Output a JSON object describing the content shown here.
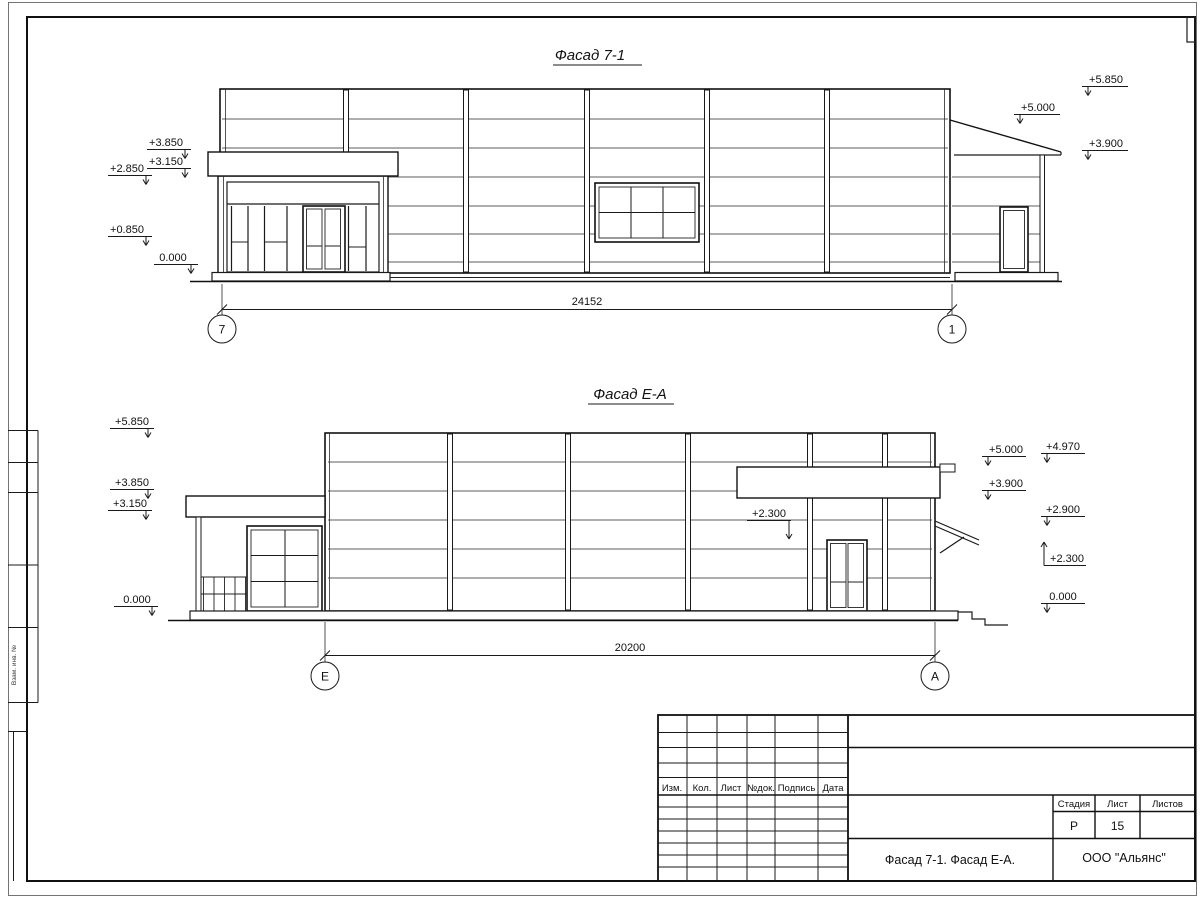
{
  "facade1": {
    "title": "Фасад 7-1",
    "marks_left": [
      "+3.850",
      "+3.150",
      "+2.850",
      "+0.850",
      "0.000"
    ],
    "marks_right": [
      "+5.850",
      "+5.000",
      "+3.900"
    ],
    "dimension": "24152",
    "axis_left": "7",
    "axis_right": "1"
  },
  "facade2": {
    "title": "Фасад Е-А",
    "marks_left": [
      "+5.850",
      "+3.850",
      "+3.150",
      "0.000"
    ],
    "mark_mid": "+2.300",
    "marks_right_col1": [
      "+5.000",
      "+3.900"
    ],
    "marks_right_col2": [
      "+4.970",
      "+2.900",
      "+2.300",
      "0.000"
    ],
    "dimension": "20200",
    "axis_left": "Е",
    "axis_right": "А"
  },
  "titleblock": {
    "header_cells": [
      "Изм.",
      "Кол.",
      "Лист",
      "№док.",
      "Подпись",
      "Дата"
    ],
    "stage_label": "Стадия",
    "sheet_label": "Лист",
    "sheets_label": "Листов",
    "stage_value": "Р",
    "sheet_value": "15",
    "drawing_name": "Фасад 7-1. Фасад Е-А.",
    "company": "ООО \"Альянс\""
  },
  "side_strip": {
    "label": "Взам. инв. №"
  }
}
